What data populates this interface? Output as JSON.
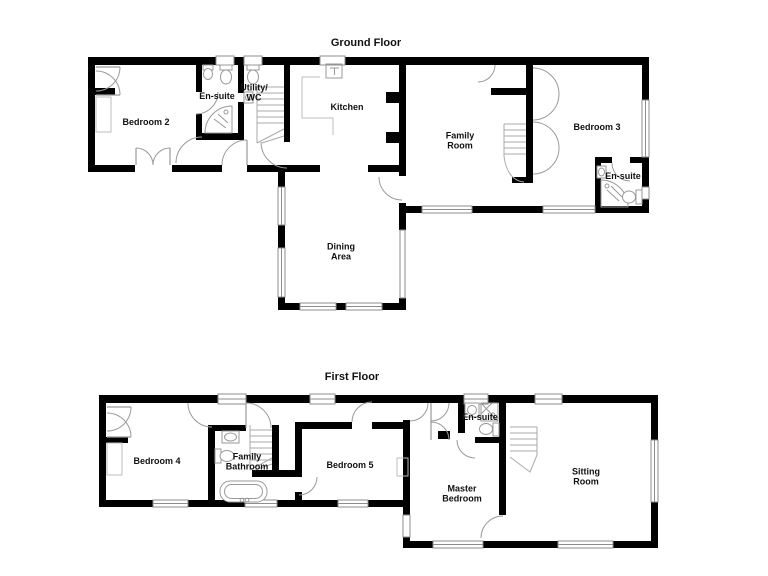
{
  "canvas": {
    "width": 768,
    "height": 576,
    "background": "#ffffff"
  },
  "palette": {
    "wall": "#000000",
    "door_line": "#9a9a9a",
    "window_line": "#8d8d8d",
    "fixture_line": "#999999",
    "label_color": "#111111"
  },
  "ground_floor": {
    "title": "Ground Floor",
    "rooms": {
      "bedroom2": "Bedroom 2",
      "ensuite": "En-suite",
      "utility_wc": "Utility/\nWC",
      "kitchen": "Kitchen",
      "family_room": "Family\nRoom",
      "bedroom3": "Bedroom 3",
      "bedroom3_ensuite": "En-suite",
      "dining_area": "Dining\nArea"
    }
  },
  "first_floor": {
    "title": "First Floor",
    "rooms": {
      "bedroom4": "Bedroom 4",
      "family_bathroom": "Family\nBathroom",
      "bedroom5": "Bedroom 5",
      "master_bedroom": "Master\nBedroom",
      "ensuite": "En-suite",
      "sitting_room": "Sitting\nRoom"
    }
  }
}
